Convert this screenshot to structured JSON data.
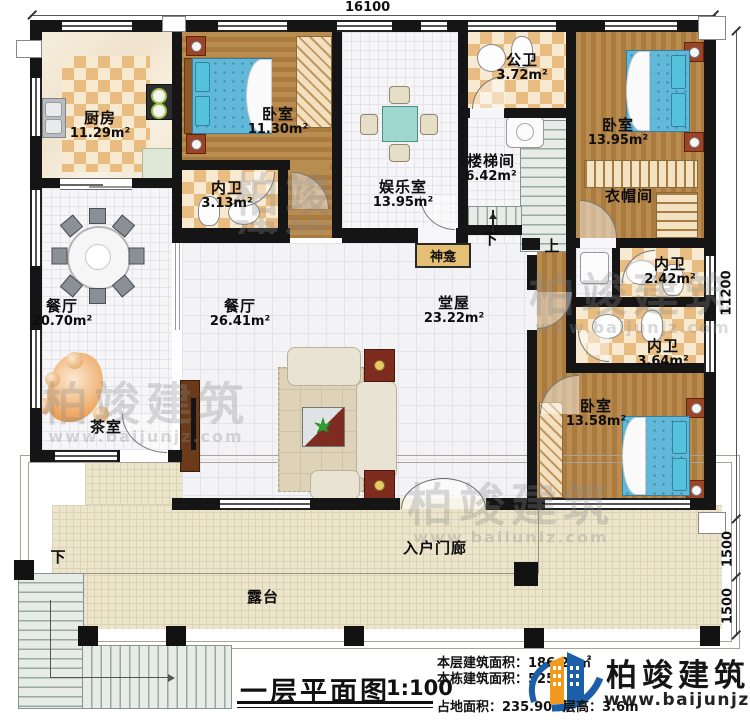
{
  "dims": {
    "top": "16100",
    "right": "11200",
    "seg_a": "1500",
    "seg_b": "1500"
  },
  "rooms": {
    "kitchen": {
      "name": "厨房",
      "area": "11.29m²"
    },
    "bedroom_top": {
      "name": "卧室",
      "area": "11.30m²"
    },
    "bath_inner_1": {
      "name": "内卫",
      "area": "3.13m²"
    },
    "entertainment": {
      "name": "娱乐室",
      "area": "13.95m²"
    },
    "public_bath": {
      "name": "公卫",
      "area": "3.72m²"
    },
    "stairwell": {
      "name": "楼梯间",
      "area": "6.42m²"
    },
    "bedroom_rt": {
      "name": "卧室",
      "area": "13.95m²"
    },
    "cloakroom": {
      "name": "衣帽间"
    },
    "bath_inner_2": {
      "name": "内卫",
      "area": "2.42m²"
    },
    "bath_inner_3": {
      "name": "内卫",
      "area": "3.64m²"
    },
    "bedroom_rb": {
      "name": "卧室",
      "area": "13.58m²"
    },
    "dining_left": {
      "name": "餐厅",
      "area": "20.70m²"
    },
    "dining_center": {
      "name": "餐厅",
      "area": "26.41m²"
    },
    "hall": {
      "name": "堂屋",
      "area": "23.22m²"
    },
    "tea_room": {
      "name": "茶室"
    },
    "shrine": {
      "name": "神龛"
    },
    "porch": {
      "name": "入户门廊"
    },
    "terrace": {
      "name": "露台"
    }
  },
  "stairs": {
    "down_label": "下",
    "up_label": "上",
    "outer_down_label": "下"
  },
  "title_block": {
    "title": "一层平面图",
    "scale": "1:100",
    "stats": {
      "floor": {
        "label": "本层建筑面积：",
        "value": "186.25㎡"
      },
      "building": {
        "label": "本栋建筑面积：",
        "value": "525."
      },
      "land": {
        "label": "占地面积：",
        "value": "235.90㎡"
      },
      "height": {
        "label": "层高：",
        "value": "3.6m"
      }
    }
  },
  "brand": {
    "name": "柏竣建筑",
    "url": "www.baijunjz.com",
    "blue": "#1a5fa8",
    "orange": "#f29a1f"
  },
  "watermark": {
    "text": "柏竣建筑",
    "url": "www.baijunjz.com"
  }
}
